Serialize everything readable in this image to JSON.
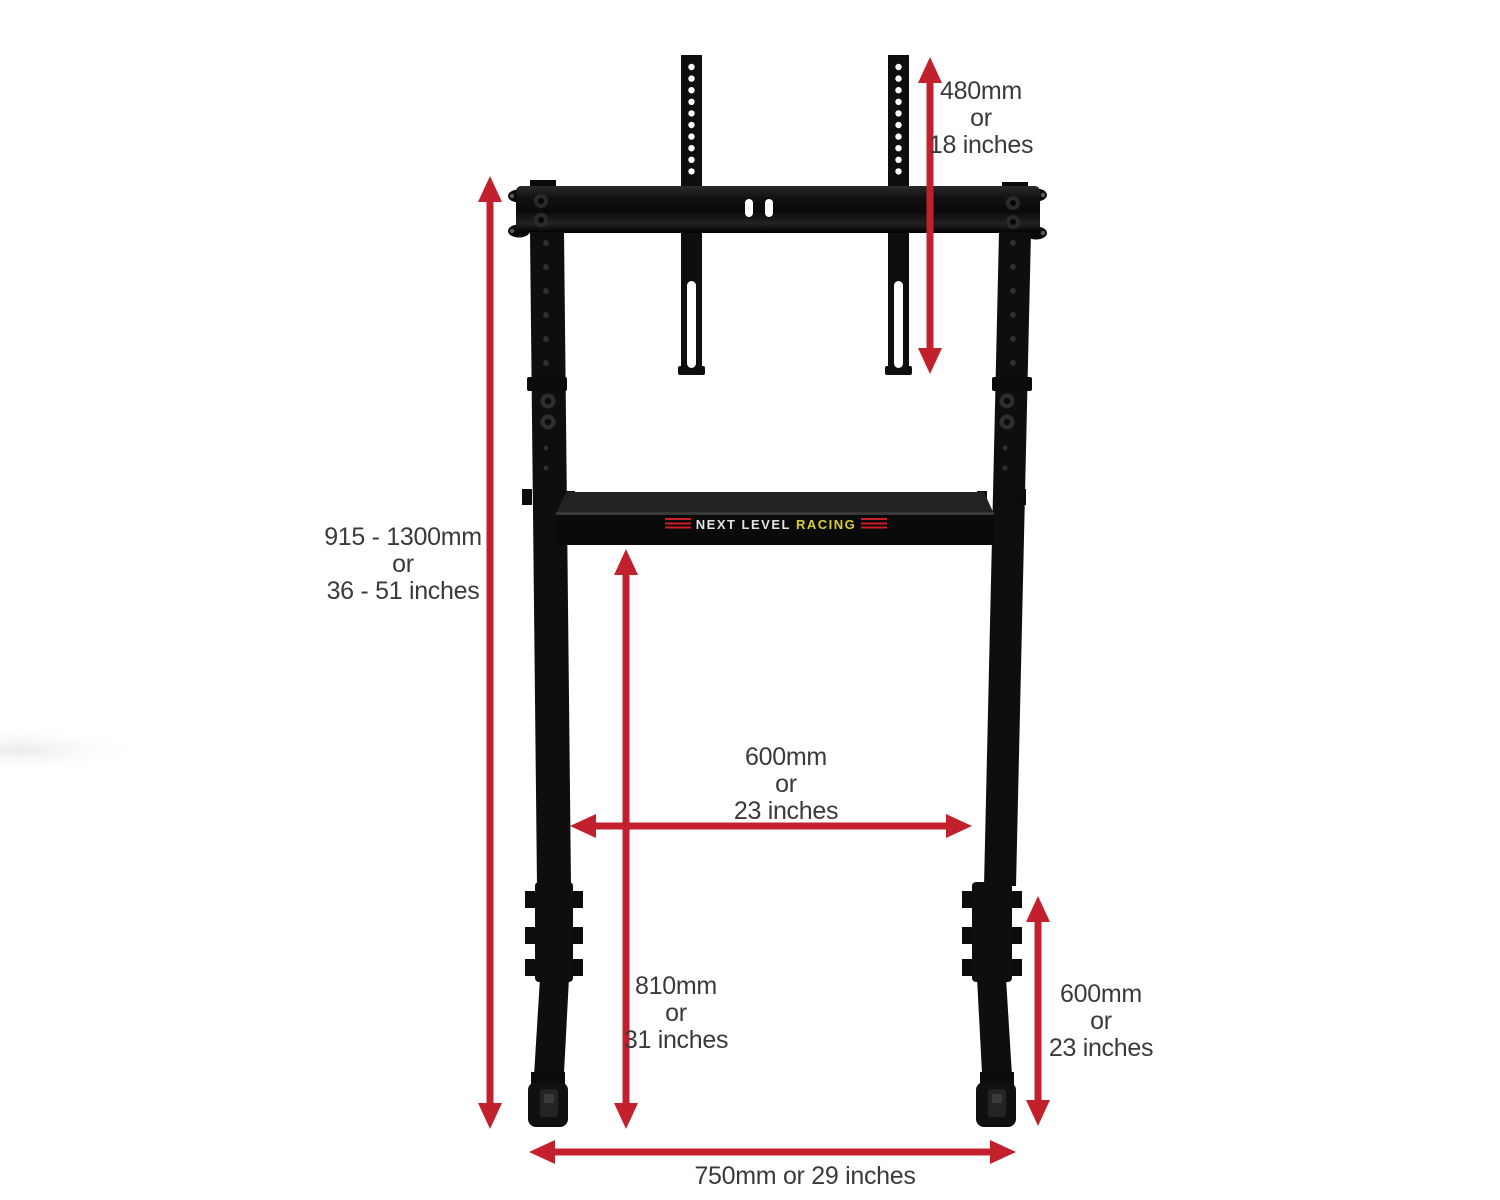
{
  "colors": {
    "arrow_red": "#c1202c",
    "label_text": "#3a3a3a",
    "stand_black": "#0e0e0e",
    "logo_silver": "#e4e4e4",
    "logo_yellow": "#d6d02f",
    "logo_red": "#cb1f27",
    "background": "#ffffff"
  },
  "logo": {
    "part1": "NEXT LEVEL",
    "part2": "RACING"
  },
  "dimensions": {
    "vesa_height": {
      "lines": [
        "480mm",
        "or",
        "18 inches"
      ]
    },
    "stand_height": {
      "lines": [
        "915 - 1300mm",
        "or",
        "36 - 51 inches"
      ]
    },
    "inner_width": {
      "lines": [
        "600mm",
        "or",
        "23 inches"
      ]
    },
    "crossbar_to_floor": {
      "lines": [
        "810mm",
        "or",
        "31 inches"
      ]
    },
    "foot_length": {
      "lines": [
        "600mm",
        "or",
        "23 inches"
      ]
    },
    "base_width": {
      "lines": [
        "750mm or 29 inches"
      ]
    }
  }
}
